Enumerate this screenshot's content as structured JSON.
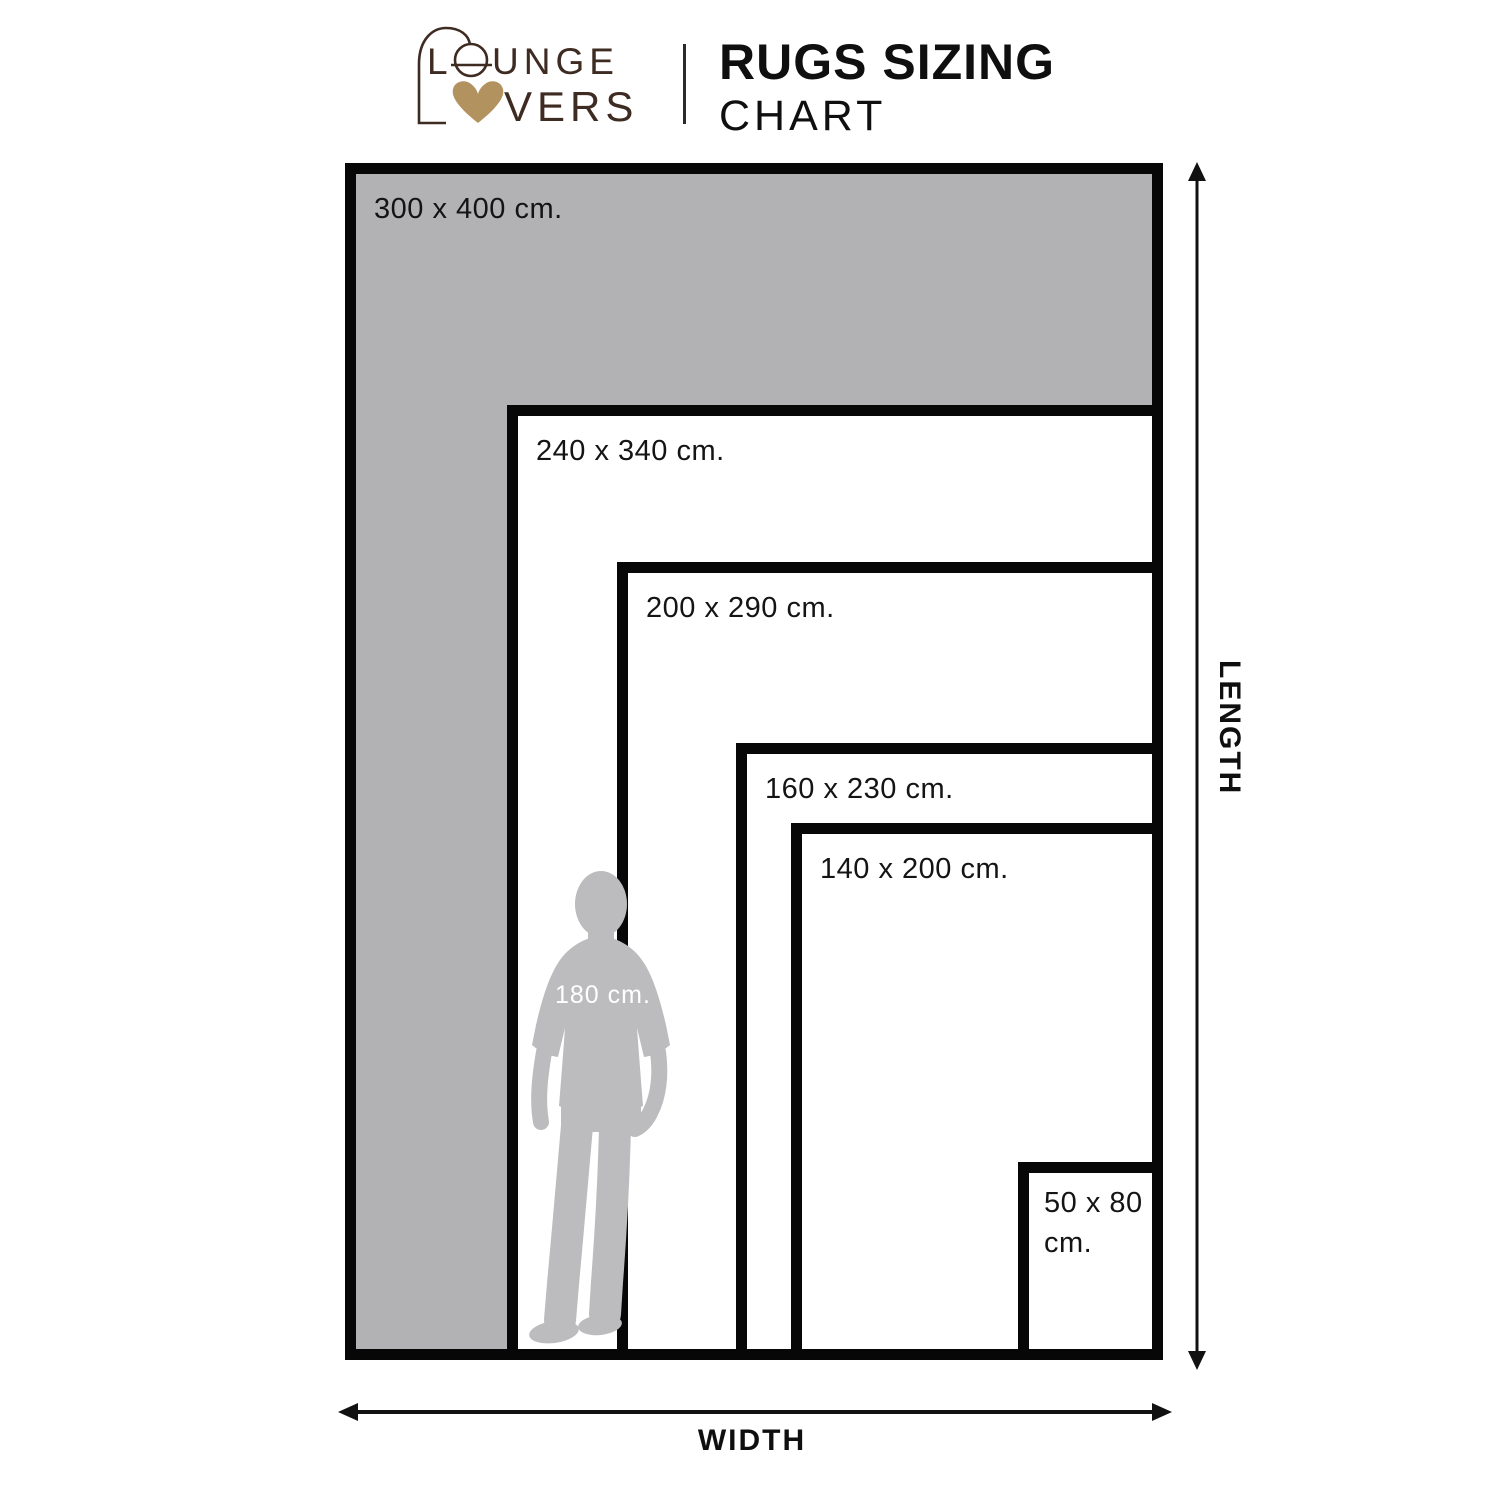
{
  "header": {
    "logo": {
      "word1_initial": "L",
      "word1_rest": "UNGE",
      "word2_rest": "VERS",
      "text_color": "#3e2b21",
      "heart_color": "#b2925f"
    },
    "title_line1": "RUGS SIZING",
    "title_line2": "CHART"
  },
  "chart_data": {
    "type": "nested_size_comparison",
    "title": "RUGS SIZING CHART",
    "unit": "cm",
    "rugs": [
      {
        "label": "300 x 400 cm.",
        "width_cm": 300,
        "length_cm": 400,
        "fill": "#b2b2b4",
        "box": {
          "left": 345,
          "top": 163
        }
      },
      {
        "label": "240 x 340 cm.",
        "width_cm": 240,
        "length_cm": 340,
        "fill": "#ffffff",
        "box": {
          "left": 507,
          "top": 405
        }
      },
      {
        "label": "200 x 290 cm.",
        "width_cm": 200,
        "length_cm": 290,
        "fill": "#ffffff",
        "box": {
          "left": 617,
          "top": 562
        }
      },
      {
        "label": "160 x 230 cm.",
        "width_cm": 160,
        "length_cm": 230,
        "fill": "#ffffff",
        "box": {
          "left": 736,
          "top": 743
        }
      },
      {
        "label": "140 x 200 cm.",
        "width_cm": 140,
        "length_cm": 200,
        "fill": "#ffffff",
        "box": {
          "left": 791,
          "top": 823
        }
      },
      {
        "label": "50 x 80 cm.",
        "width_cm": 50,
        "length_cm": 80,
        "fill": "#ffffff",
        "box": {
          "left": 1018,
          "top": 1162
        }
      }
    ],
    "shared_right": 1163,
    "shared_bottom": 1360,
    "border_color": "#070707",
    "axes": {
      "vertical_label": "LENGTH",
      "horizontal_label": "WIDTH"
    },
    "person": {
      "label": "180 cm.",
      "height_cm": 180,
      "fill": "#bcbcbe"
    }
  }
}
